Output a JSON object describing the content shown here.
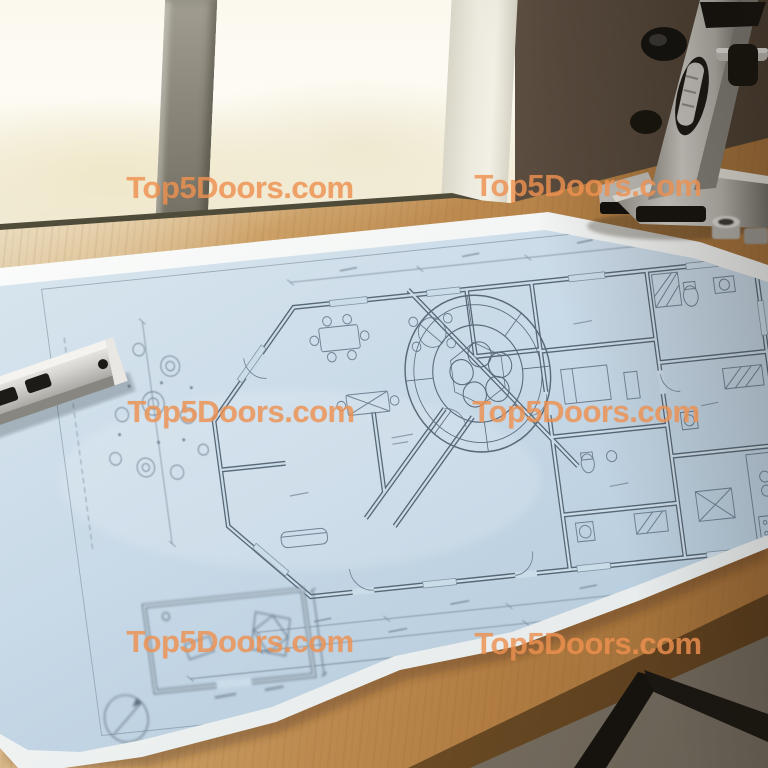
{
  "watermark": {
    "text": "Top5Doors.com",
    "color": "#ee9150",
    "opacity": 0.82,
    "instances": [
      {
        "x": 240,
        "y": 188
      },
      {
        "x": 588,
        "y": 186
      },
      {
        "x": 241,
        "y": 412
      },
      {
        "x": 586,
        "y": 412
      },
      {
        "x": 240,
        "y": 642
      },
      {
        "x": 588,
        "y": 644
      }
    ]
  },
  "palette": {
    "window_glass": "#f8f4e6",
    "window_mullion": "#84806f",
    "window_frame": "#e9e7db",
    "wall": "#5c4f43",
    "desk_wood": "#bd8c52",
    "paper_white": "#f3f5f4",
    "blueprint_blue": "#c9dae8",
    "plan_line": "#5a6a78",
    "ruler_metal": "#d2d1cd",
    "tool_metal": "#c6c4bf",
    "tool_black": "#161310",
    "floor": "#7d7468",
    "desk_legs": "#17140f"
  }
}
